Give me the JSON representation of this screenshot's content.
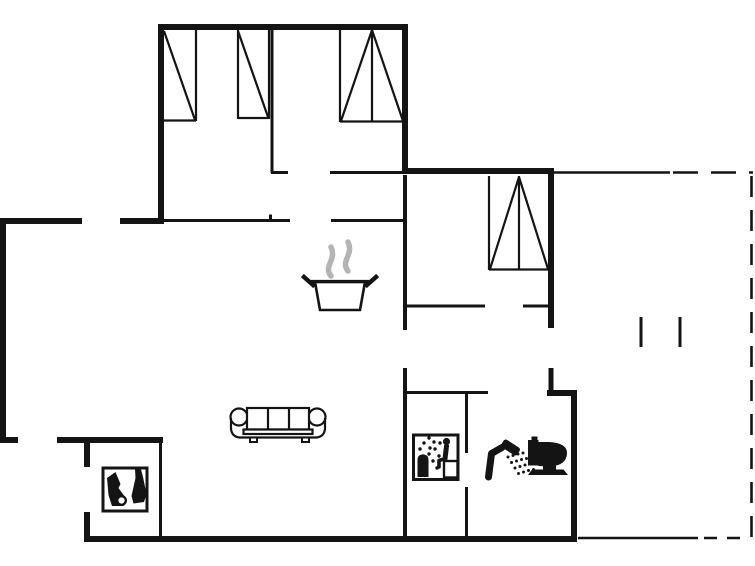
{
  "plan": {
    "type": "house-floor-plan",
    "background_color": "#ffffff",
    "wall_color": "#141414",
    "steam_color": "#b4b4b4",
    "window_symbols": 4,
    "terrace": {
      "style": "dashed-boundary",
      "side": "right"
    },
    "icons": {
      "pot": {
        "name": "cooking-pot-icon",
        "label": "cooking pot with steam (kitchen)"
      },
      "sofa": {
        "name": "sofa-icon",
        "label": "three-seat sofa (living room)"
      },
      "stove": {
        "name": "wood-stove-icon",
        "label": "wood stove"
      },
      "sauna": {
        "name": "sauna-icon",
        "label": "sauna"
      },
      "shower": {
        "name": "shower-icon",
        "label": "shower"
      },
      "toilet": {
        "name": "toilet-icon",
        "label": "toilet"
      }
    }
  }
}
